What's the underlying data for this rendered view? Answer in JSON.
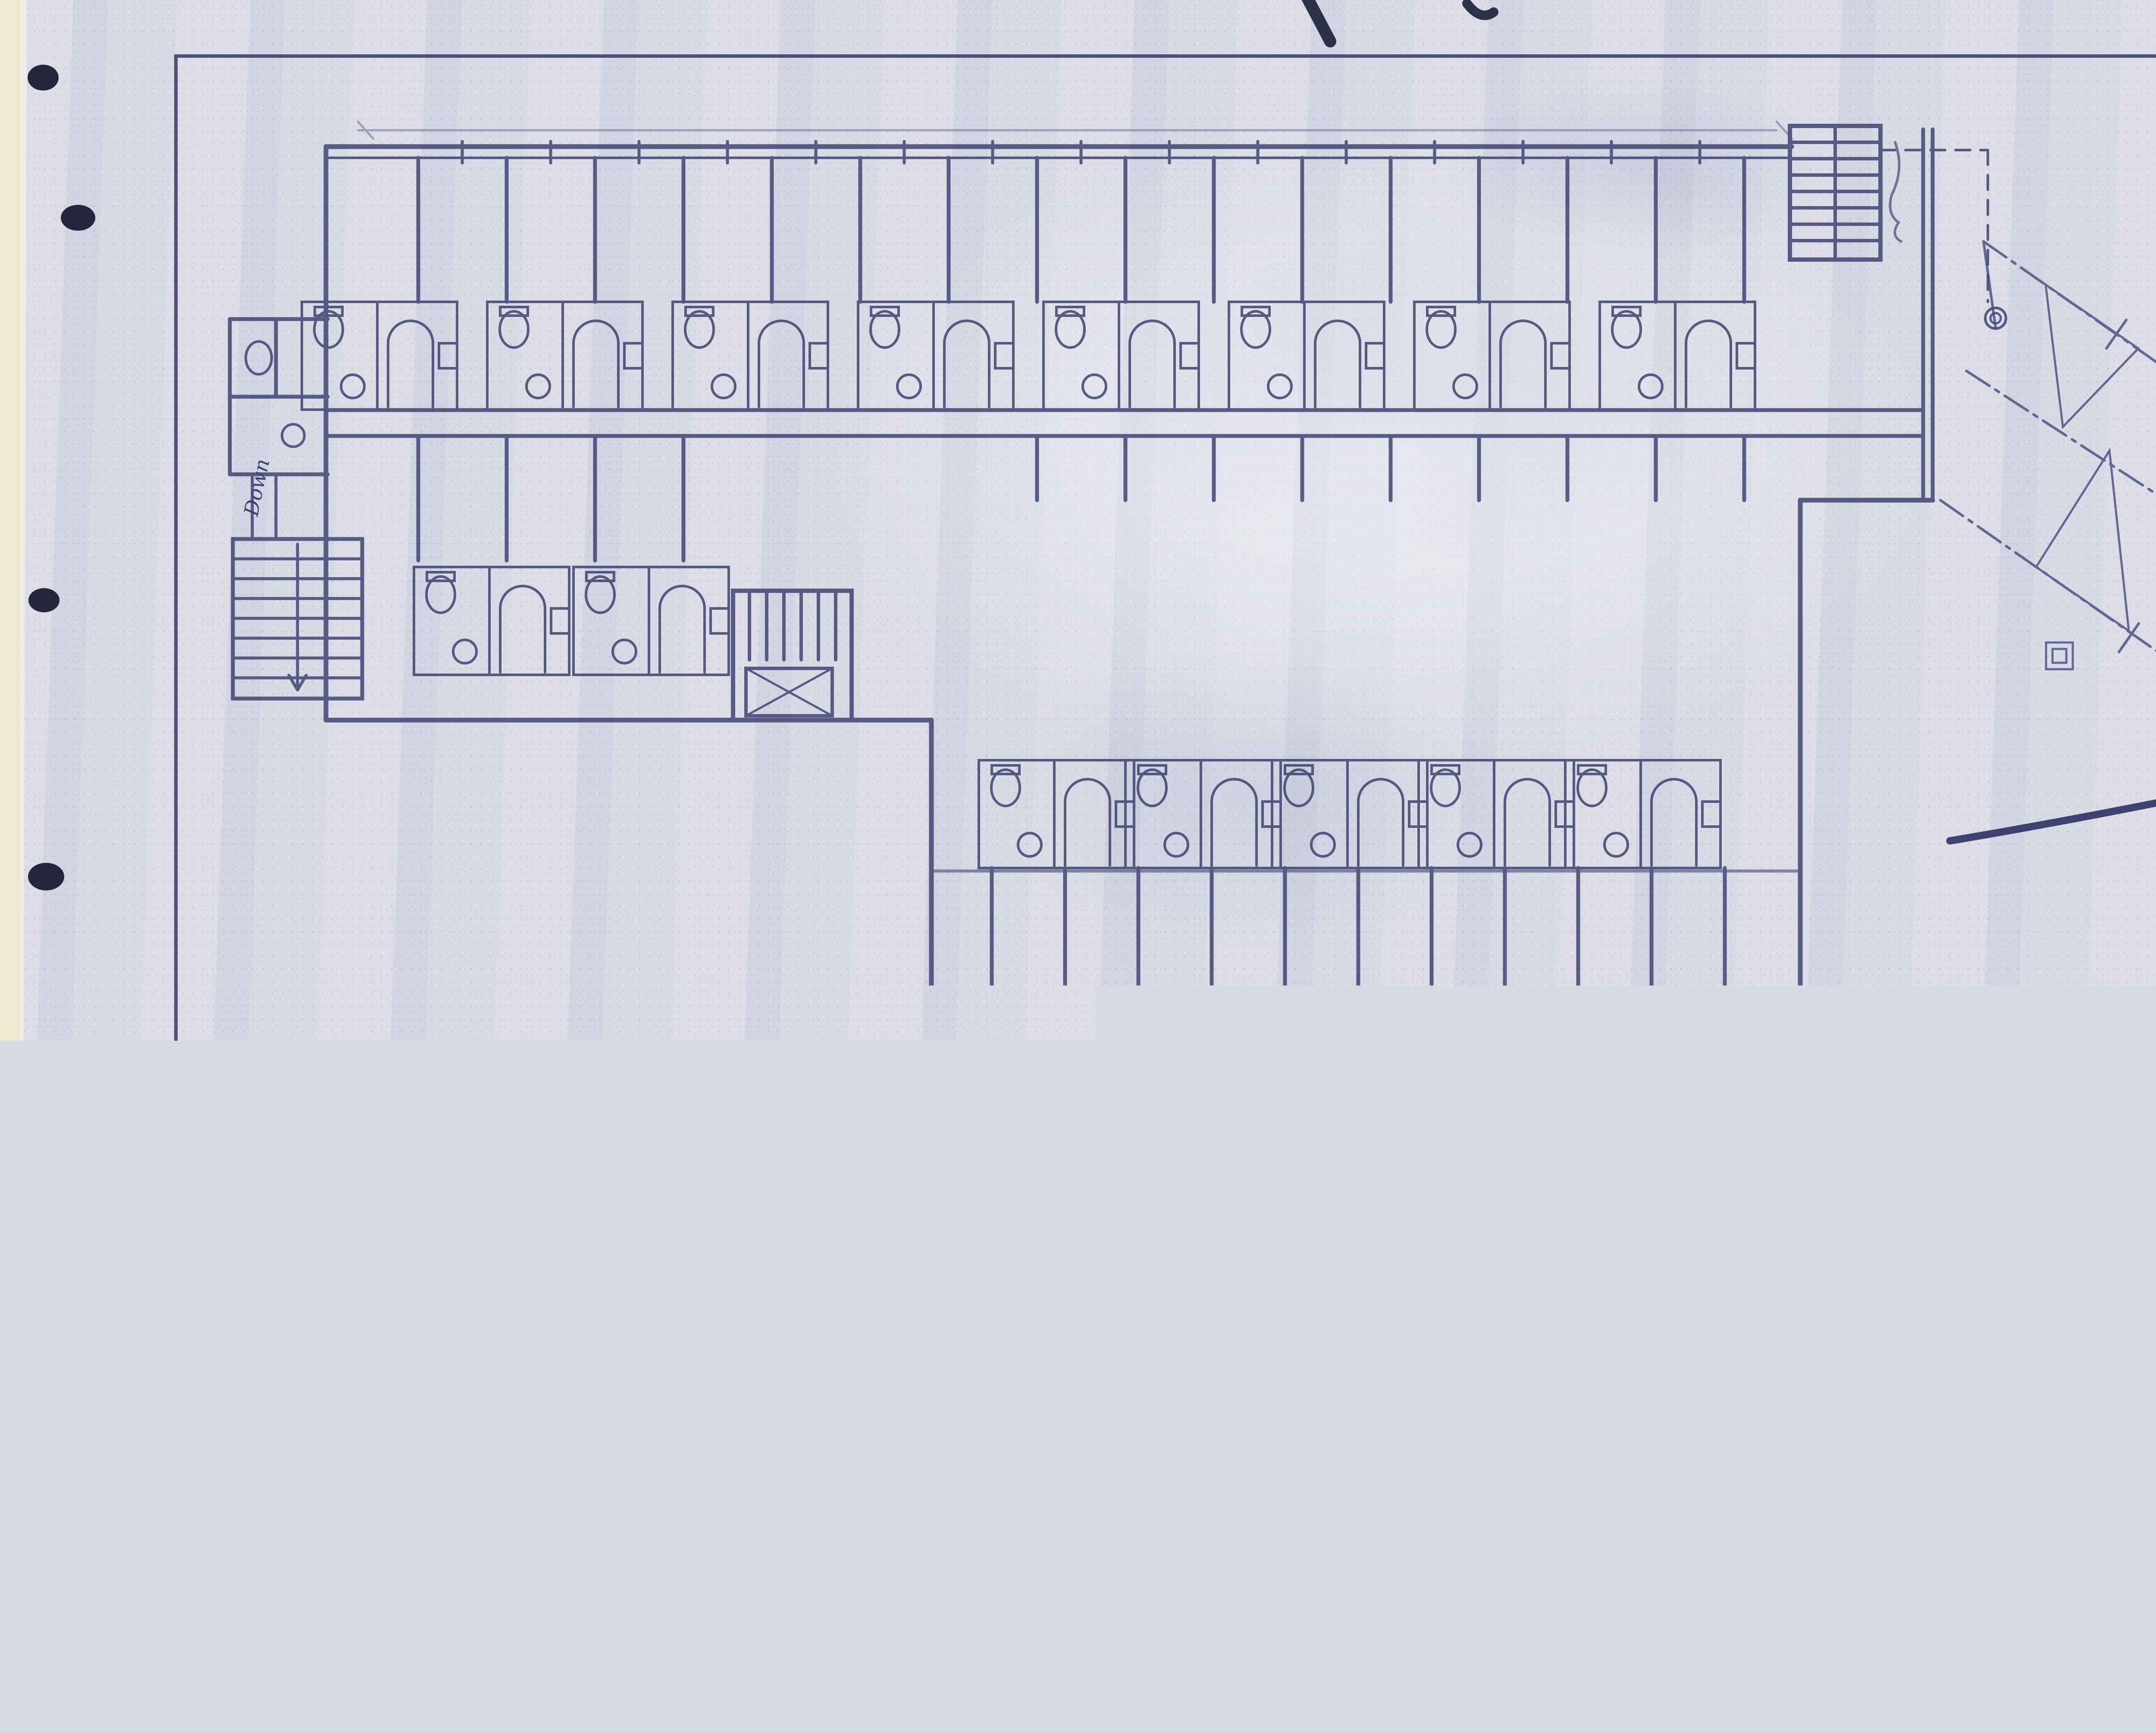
{
  "annotations": {
    "note_line1": "NOTE: SEE 4TH FLOOR PLAN ON",
    "note_line2": "SUPPLEMENTARY FLOOR PLANS",
    "void": "V O I D",
    "void_sub": "SEE SUPPLEMENTARY FLOOR PLANS",
    "stair_down": "Down"
  },
  "title_block": {
    "work_no_label": "Work No.",
    "work_no": "451",
    "drawn_by_label": "Drawn By",
    "drawn_by": "E.J.S",
    "traced_by_label": "Traced By",
    "traced_by": "L.C.B.",
    "title": "THIRD · FLOOR · PLAN ·",
    "client_line1": "HOTEL AT GLACIER POINT",
    "client_line2": "FOR THE",
    "client_line3": "DESMOND PARK SERVICE CO.",
    "client_line4": "SAN FRANCISCO",
    "sheet_no_label": "Sheet No.",
    "sheet_no": "#4",
    "scale_label": "Scale",
    "scale": "⅛\" = 1'",
    "date_label": "Date",
    "date": "7/26/16",
    "architect_name": "EDWIN J. SYMMES",
    "architect_title": "ARCHITECT",
    "architect_addr1": "721-722 PACIFIC BLDG.",
    "architect_addr2": "SAN FRANCISCO."
  },
  "colors": {
    "paper": "#d8dae5",
    "ink": "#3a3f6e",
    "heavy_ink": "#262a52",
    "scan_background": "#edeee3",
    "punch_hole": "#15172c"
  }
}
